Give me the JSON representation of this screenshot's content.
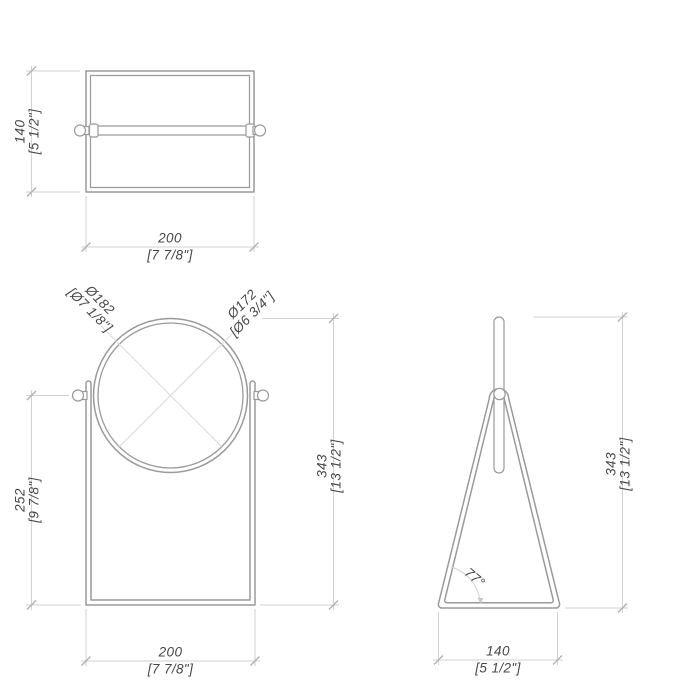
{
  "drawing": {
    "type": "technical-orthographic-drawing",
    "subject": "table mirror with triangular stand",
    "colors": {
      "geometry_line": "#9a9a9a",
      "dimension_line": "#d2d2d2",
      "construction_line": "#dcdcdc",
      "text": "#474747"
    },
    "views": {
      "top": {
        "label": "top view",
        "depth": {
          "mm": "140",
          "in": "[5 1/2\"]"
        },
        "width": {
          "mm": "200",
          "in": "[7 7/8\"]"
        }
      },
      "front": {
        "label": "front view",
        "outer_diameter": {
          "mm": "Ø182",
          "in": "[Ø7 1/8\"]"
        },
        "inner_diameter": {
          "mm": "Ø172",
          "in": "[Ø6 3/4\"]"
        },
        "frame_height": {
          "mm": "252",
          "in": "[9 7/8\"]"
        },
        "total_height": {
          "mm": "343",
          "in": "[13 1/2\"]"
        },
        "width": {
          "mm": "200",
          "in": "[7 7/8\"]"
        }
      },
      "side": {
        "label": "side view",
        "total_height": {
          "mm": "343",
          "in": "[13 1/2\"]"
        },
        "base_width": {
          "mm": "140",
          "in": "[5 1/2\"]"
        },
        "base_angle": "77°"
      }
    }
  }
}
